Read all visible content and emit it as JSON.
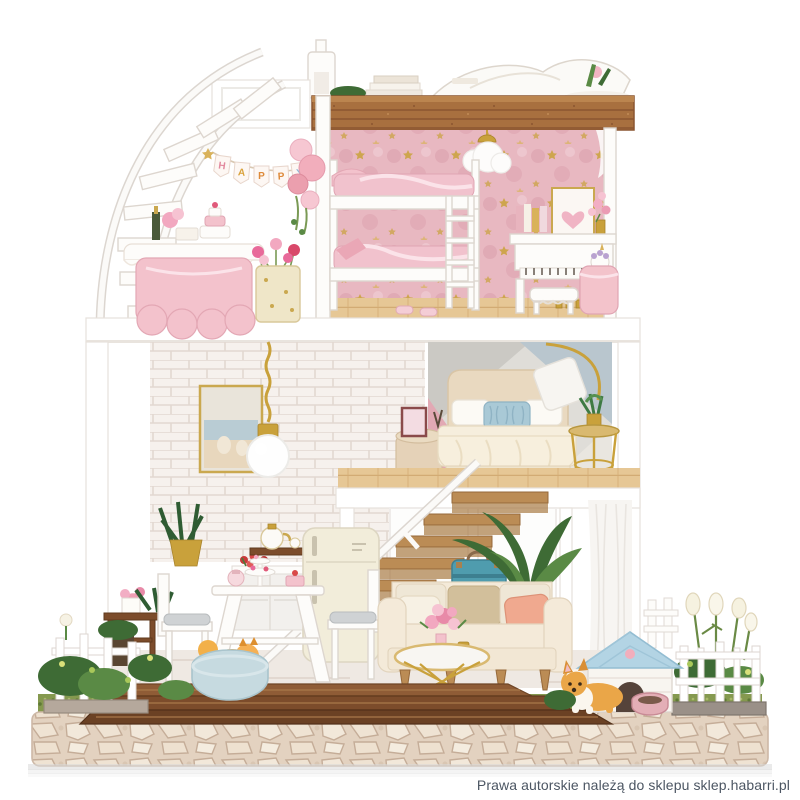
{
  "image": {
    "kind": "product-photo",
    "subject": "DIY miniature dollhouse on white background",
    "background": "#ffffff"
  },
  "watermark": {
    "text": "Prawa autorskie należą do sklepu sklep.habarri.pl",
    "color": "#4c5663"
  },
  "banner": {
    "text": "HAPPY",
    "letters": [
      "H",
      "A",
      "P",
      "P",
      "Y"
    ],
    "letter_colors": [
      "#e2899e",
      "#d9a23c",
      "#de8a3a",
      "#de8a3a",
      "#8fb3d6"
    ]
  },
  "palette": {
    "parapet_wood": "#a8703f",
    "deck_wood": "#7c4c2b",
    "pink_wallpaper": "#e8b8c1",
    "wood_floor": "#e6c795",
    "brick_wall": "#f6f1ed",
    "bedroom_wall_gray": "#dfddd8",
    "bedroom_wall_pink": "#e2a9b4",
    "bedroom_wall_blue": "#b9c6ce",
    "gold_accent": "#c9a13b",
    "bed_cream": "#e9d9c0",
    "pillow_blue": "#a9c9d6",
    "sofa_cream": "#f4ead9",
    "pillow_salmon": "#f0a98f",
    "suitcase_blue": "#4f9cae",
    "doghouse_roof": "#b3d4e4",
    "pet_orange": "#eaa648",
    "pet_bed_blue": "#c6dae0",
    "cobblestone": "#e3d2c0",
    "grass": "#85994f",
    "fence_white": "#ffffff"
  },
  "scene": {
    "rooftop_terrace": [
      "chimney lamp",
      "white lounge book",
      "book stack",
      "plant bowl",
      "wooden parapet"
    ],
    "top_floor_left": [
      "spiral staircase",
      "HAPPY pennant banner",
      "pink balloons",
      "party table with cake",
      "candy bucket"
    ],
    "top_floor_room": [
      "pink star wallpaper",
      "cloud ceiling lamp",
      "white bunk bed",
      "ladder",
      "slippers",
      "white piano",
      "heart picture",
      "flower vase",
      "piano bench",
      "pink basket with unicorn"
    ],
    "middle_floor_left": [
      "white brick wall",
      "gold pendant globe lamp",
      "framed beach photo",
      "wooden staircase"
    ],
    "middle_floor_bedroom": [
      "geometric wallpaper",
      "cream double bed",
      "blue pillow",
      "gold arc floor lamp",
      "gold side table with plant",
      "bedside stool with photo"
    ],
    "ground_floor_kitchen": [
      "cream retro fridge",
      "counter with red flowers",
      "tea pot shelf",
      "white dining table",
      "two chairs",
      "tea party sweets",
      "potted plant",
      "wooden side stand"
    ],
    "ground_floor_living": [
      "cream sofa",
      "salmon pillow",
      "gold coffee table",
      "pink bouquet",
      "blue suitcase",
      "large green plant",
      "sheer curtain"
    ],
    "garden": [
      "wooden deck steps",
      "cobblestone base",
      "grass",
      "left white fence",
      "right white fence",
      "dog house with blue roof",
      "corgi dog",
      "pomeranian in blue pet bed",
      "pink food bowl",
      "white flowers",
      "green bushes"
    ]
  }
}
